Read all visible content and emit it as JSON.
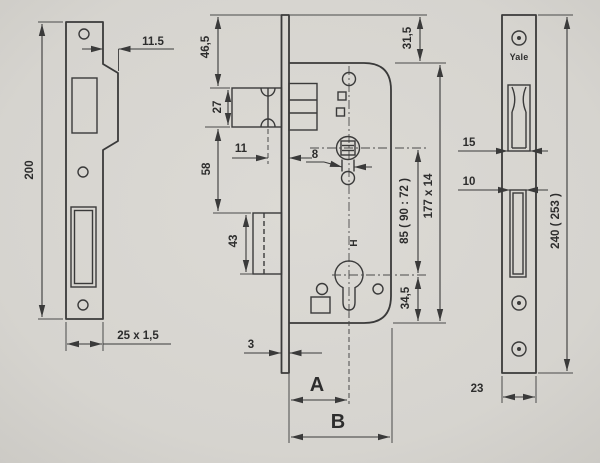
{
  "meta": {
    "description": "Technical dimensional drawing of a Yale mortise sash lock: strike plate, lock case side view and forend face plate"
  },
  "colors": {
    "paper": "#d8d6d1",
    "paper_edge": "#cfcdc8",
    "ink": "#3a3a3a"
  },
  "strike_plate": {
    "height": "200",
    "lip_offset": "11.5",
    "section": "25 x 1,5"
  },
  "lock_case": {
    "top_to_latch": "46,5",
    "latch_height": "27",
    "latch_to_deadbolt": "58",
    "deadbolt_height": "43",
    "latch_offset": "11",
    "spindle_square": "8",
    "faceplate_thickness": "3",
    "top_offset": "31,5",
    "case_size": "177 x 14",
    "centre_distance": "85 ( 90 : 72 )",
    "cylinder_to_base": "34,5",
    "backset_label": "A",
    "depth_label": "B",
    "handing_mark": "H"
  },
  "face_plate": {
    "brand": "Yale",
    "latch_cutout_width": "15",
    "deadbolt_cutout_width": "10",
    "height": "240 ( 253 )",
    "width": "23"
  }
}
